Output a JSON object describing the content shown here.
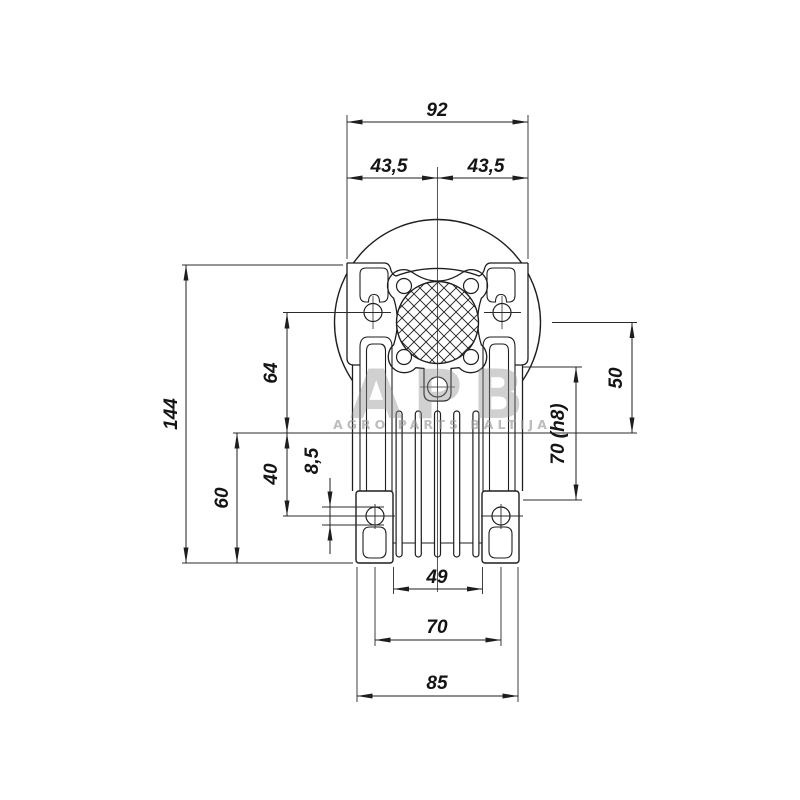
{
  "drawing": {
    "subject": "worm-gearbox-front-view-dimension-drawing",
    "dimensions": {
      "flange_width_total": "92",
      "flange_half_left": "43,5",
      "flange_half_right": "43,5",
      "height_total": "144",
      "height_upper": "64",
      "height_lower": "60",
      "height_axis_to_foot_hole": "40",
      "foot_hole_diameter": "8,5",
      "height_shaft_to_axis": "50",
      "spigot_diameter": "70 (h8)",
      "fin_section_width": "49",
      "foot_hole_spacing": "70",
      "feet_width_total": "85"
    },
    "colors": {
      "line": "#1e1e1e",
      "background": "#ffffff",
      "watermark": "#9a9a9a"
    }
  },
  "watermark": {
    "logo": "APB",
    "subtitle": "AGRO PARTS BALTIJA"
  }
}
